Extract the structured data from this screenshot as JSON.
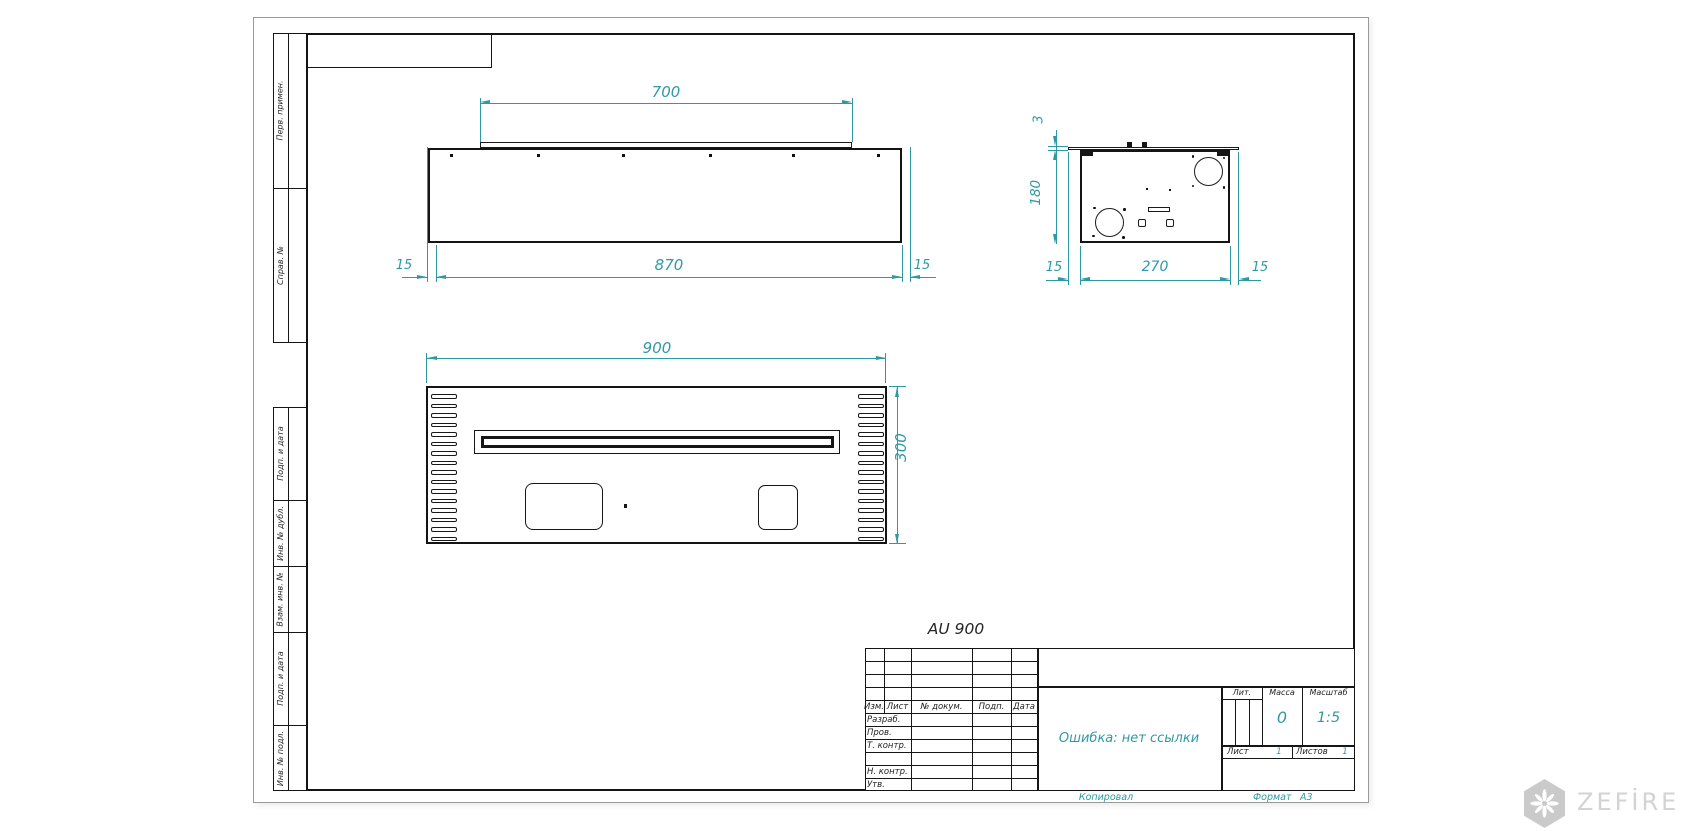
{
  "drawing": {
    "title": "AU 900",
    "colors": {
      "dimension": "#2f99a3",
      "line": "#141414"
    },
    "views": {
      "front": {
        "dim_top": "700",
        "dim_bottom": "870",
        "dim_left": "15",
        "dim_right": "15"
      },
      "side": {
        "dim_flange": "3",
        "dim_height": "180",
        "dim_left": "15",
        "dim_depth": "270",
        "dim_right": "15"
      },
      "top": {
        "dim_width": "900",
        "dim_height": "300"
      }
    }
  },
  "side_stamps": {
    "items": [
      "Перв. примен.",
      "Справ. №",
      "Подп. и дата",
      "Инв. № дубл.",
      "Взам. инв. №",
      "Подп. и дата",
      "Инв. № подл."
    ]
  },
  "title_block": {
    "change_header": {
      "izm": "Изм.",
      "list": "Лист",
      "doc": "№ докум.",
      "podp": "Подп.",
      "data": "Дата"
    },
    "role_rows": [
      "Разраб.",
      "Пров.",
      "Т. контр.",
      "",
      "Н. контр.",
      "Утв."
    ],
    "doc_name": "Ошибка: нет ссылки",
    "lit_label": "Лит.",
    "mass_label": "Масса",
    "mass_value": "0",
    "scale_label": "Масштаб",
    "scale_value": "1:5",
    "sheet_label": "Лист",
    "sheet_value": "1",
    "sheets_label": "Листов",
    "sheets_value": "1"
  },
  "footer": {
    "copied_label": "Копировал",
    "format_label": "Формат",
    "format_value": "A3"
  },
  "watermark": {
    "brand": "ZEFİRE"
  }
}
